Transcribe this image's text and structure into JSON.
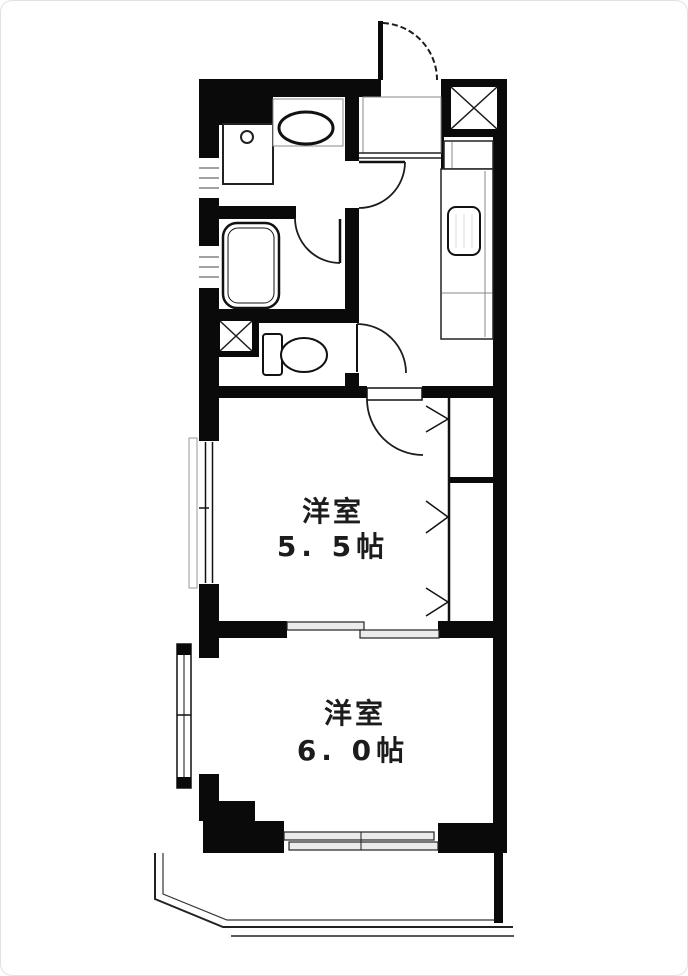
{
  "floorplan": {
    "type": "apartment-floor-plan",
    "colors": {
      "wall": "#0a0a0a",
      "background": "#ffffff",
      "line": "#1c1c1c",
      "panel_fill": "#ebebeb"
    },
    "rooms": [
      {
        "name": "洋室",
        "size": "5. 5帖"
      },
      {
        "name": "洋室",
        "size": "6. 0帖"
      }
    ],
    "fixtures": [
      "entrance-door",
      "pipe-space-hatch",
      "kitchen-counter",
      "kitchen-sink",
      "wash-basin",
      "washing-machine-pan",
      "bathtub",
      "toilet",
      "closet-folding-doors",
      "sliding-door",
      "windows",
      "balcony"
    ]
  }
}
